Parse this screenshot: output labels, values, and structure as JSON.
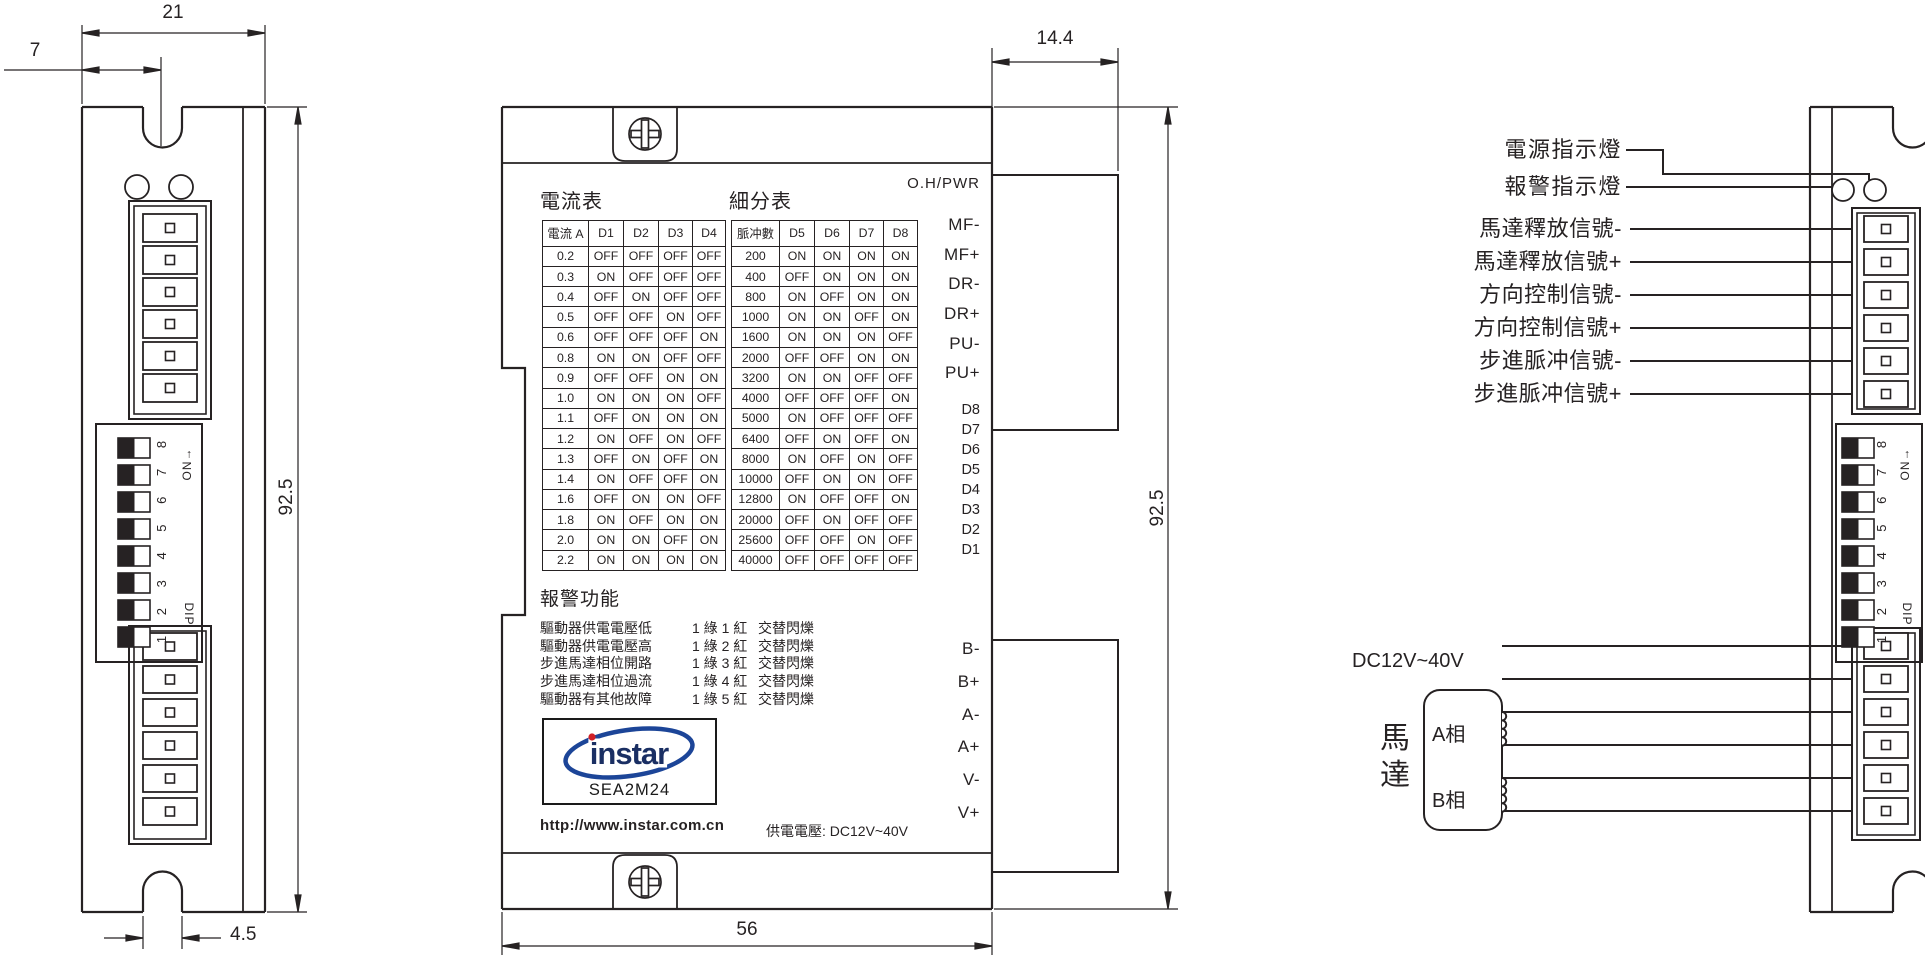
{
  "dimensions": {
    "left_width": "21",
    "left_notch_offset": "7",
    "left_height": "92.5",
    "left_slot_width": "4.5",
    "mid_depth": "14.4",
    "mid_height": "92.5",
    "mid_width": "56"
  },
  "middle_panel": {
    "status_label": "O.H/PWR",
    "current_table": {
      "title": "電流表",
      "headers": [
        "電流 A",
        "D1",
        "D2",
        "D3",
        "D4"
      ],
      "rows": [
        [
          "0.2",
          "OFF",
          "OFF",
          "OFF",
          "OFF"
        ],
        [
          "0.3",
          "ON",
          "OFF",
          "OFF",
          "OFF"
        ],
        [
          "0.4",
          "OFF",
          "ON",
          "OFF",
          "OFF"
        ],
        [
          "0.5",
          "OFF",
          "OFF",
          "ON",
          "OFF"
        ],
        [
          "0.6",
          "OFF",
          "OFF",
          "OFF",
          "ON"
        ],
        [
          "0.8",
          "ON",
          "ON",
          "OFF",
          "OFF"
        ],
        [
          "0.9",
          "OFF",
          "OFF",
          "ON",
          "ON"
        ],
        [
          "1.0",
          "ON",
          "ON",
          "ON",
          "OFF"
        ],
        [
          "1.1",
          "OFF",
          "ON",
          "ON",
          "ON"
        ],
        [
          "1.2",
          "ON",
          "OFF",
          "ON",
          "OFF"
        ],
        [
          "1.3",
          "OFF",
          "ON",
          "OFF",
          "ON"
        ],
        [
          "1.4",
          "ON",
          "OFF",
          "OFF",
          "ON"
        ],
        [
          "1.6",
          "OFF",
          "ON",
          "ON",
          "OFF"
        ],
        [
          "1.8",
          "ON",
          "OFF",
          "ON",
          "ON"
        ],
        [
          "2.0",
          "ON",
          "ON",
          "OFF",
          "ON"
        ],
        [
          "2.2",
          "ON",
          "ON",
          "ON",
          "ON"
        ]
      ]
    },
    "subdivision_table": {
      "title": "細分表",
      "headers": [
        "脈冲數",
        "D5",
        "D6",
        "D7",
        "D8"
      ],
      "rows": [
        [
          "200",
          "ON",
          "ON",
          "ON",
          "ON"
        ],
        [
          "400",
          "OFF",
          "ON",
          "ON",
          "ON"
        ],
        [
          "800",
          "ON",
          "OFF",
          "ON",
          "ON"
        ],
        [
          "1000",
          "ON",
          "ON",
          "OFF",
          "ON"
        ],
        [
          "1600",
          "ON",
          "ON",
          "ON",
          "OFF"
        ],
        [
          "2000",
          "OFF",
          "OFF",
          "ON",
          "ON"
        ],
        [
          "3200",
          "ON",
          "ON",
          "OFF",
          "OFF"
        ],
        [
          "4000",
          "OFF",
          "OFF",
          "OFF",
          "ON"
        ],
        [
          "5000",
          "ON",
          "OFF",
          "OFF",
          "OFF"
        ],
        [
          "6400",
          "OFF",
          "ON",
          "OFF",
          "ON"
        ],
        [
          "8000",
          "ON",
          "OFF",
          "ON",
          "OFF"
        ],
        [
          "10000",
          "OFF",
          "ON",
          "ON",
          "OFF"
        ],
        [
          "12800",
          "ON",
          "OFF",
          "OFF",
          "ON"
        ],
        [
          "20000",
          "OFF",
          "ON",
          "OFF",
          "OFF"
        ],
        [
          "25600",
          "OFF",
          "OFF",
          "ON",
          "OFF"
        ],
        [
          "40000",
          "OFF",
          "OFF",
          "OFF",
          "OFF"
        ]
      ]
    },
    "pins_top": [
      "MF-",
      "MF+",
      "DR-",
      "DR+",
      "PU-",
      "PU+"
    ],
    "dip_pin_labels": [
      "D8",
      "D7",
      "D6",
      "D5",
      "D4",
      "D3",
      "D2",
      "D1"
    ],
    "pins_bottom": [
      "B-",
      "B+",
      "A-",
      "A+",
      "V-",
      "V+"
    ],
    "alarm": {
      "title": "報警功能",
      "rows": [
        {
          "fault": "驅動器供電電壓低",
          "code": "1 綠 1 紅",
          "mode": "交替閃爍"
        },
        {
          "fault": "驅動器供電電壓高",
          "code": "1 綠 2 紅",
          "mode": "交替閃爍"
        },
        {
          "fault": "步進馬達相位開路",
          "code": "1 綠 3 紅",
          "mode": "交替閃爍"
        },
        {
          "fault": "步進馬達相位過流",
          "code": "1 綠 4 紅",
          "mode": "交替閃爍"
        },
        {
          "fault": "驅動器有其他故障",
          "code": "1 綠 5 紅",
          "mode": "交替閃爍"
        }
      ]
    },
    "logo": {
      "brand": "instar",
      "model": "SEA2M24"
    },
    "url": "http://www.instar.com.cn",
    "power_note": "供電電壓: DC12V~40V"
  },
  "dip_switch": {
    "numbers": "1 2 3 4 5 6 7 8",
    "on_label": "ON→",
    "dip_label": "DIP"
  },
  "right_panel": {
    "led_labels": [
      "電源指示燈",
      "報警指示燈"
    ],
    "signal_labels": [
      "馬達釋放信號-",
      "馬達釋放信號+",
      "方向控制信號-",
      "方向控制信號+",
      "步進脈冲信號-",
      "步進脈冲信號+"
    ],
    "power_label": "DC12V~40V",
    "motor_label": "馬達",
    "phase_a": "A相",
    "phase_b": "B相"
  },
  "colors": {
    "line": "#262223",
    "logo_blue": "#1c4598",
    "logo_navy": "#1a2f63",
    "logo_red": "#cf2027"
  }
}
